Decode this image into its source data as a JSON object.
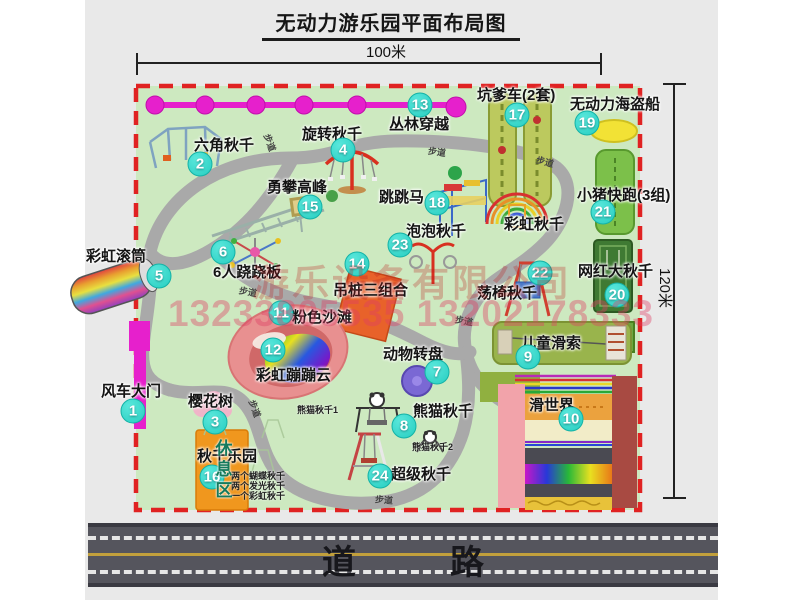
{
  "title": {
    "text": "无动力游乐园平面布局图"
  },
  "dimensions": {
    "width": "100米",
    "height": "120米"
  },
  "road": {
    "label": "道　路"
  },
  "rest_area": {
    "label": "休息区"
  },
  "watermark": {
    "company": "游乐设备有限公司",
    "phone": "13233805535 13202178333"
  },
  "colors": {
    "park_green": "#cde9c0",
    "border_red": "#e02222",
    "path_gray": "#a9a9a9",
    "badge_teal": "#27cdc0",
    "magenta": "#e620cc",
    "road_gray": "#55555d",
    "rest_orange": "#f0971e"
  },
  "map": {
    "attractions": [
      {
        "num": 1,
        "name": "风车大门",
        "label": [
          101,
          380
        ],
        "circle": [
          133,
          411
        ]
      },
      {
        "num": 2,
        "name": "六角秋千",
        "label": [
          194,
          134
        ],
        "circle": [
          200,
          164
        ]
      },
      {
        "num": 3,
        "name": "樱花树",
        "label": [
          188,
          390
        ],
        "circle": [
          215,
          422
        ]
      },
      {
        "num": 4,
        "name": "旋转秋千",
        "label": [
          302,
          123
        ],
        "circle": [
          343,
          150
        ]
      },
      {
        "num": 5,
        "name": "彩虹滚筒",
        "label": [
          86,
          245
        ],
        "circle": [
          159,
          276
        ]
      },
      {
        "num": 6,
        "name": "6人跷跷板",
        "label": [
          213,
          261
        ],
        "circle": [
          223,
          252
        ]
      },
      {
        "num": 7,
        "name": "动物转盘",
        "label": [
          383,
          343
        ],
        "circle": [
          437,
          372
        ]
      },
      {
        "num": 8,
        "name": "熊猫秋千",
        "label": [
          413,
          400
        ],
        "circle": [
          404,
          426
        ]
      },
      {
        "num": 9,
        "name": "儿童滑索",
        "label": [
          521,
          332
        ],
        "circle": [
          528,
          357
        ]
      },
      {
        "num": 10,
        "name": "滑世界",
        "label": [
          529,
          394
        ],
        "circle": [
          571,
          419
        ]
      },
      {
        "num": 11,
        "name": "粉色沙滩",
        "label": [
          292,
          306
        ],
        "circle": [
          281,
          313
        ]
      },
      {
        "num": 12,
        "name": "彩虹蹦蹦云",
        "label": [
          256,
          364
        ],
        "circle": [
          273,
          350
        ]
      },
      {
        "num": 13,
        "name": "丛林穿越",
        "label": [
          389,
          113
        ],
        "circle": [
          420,
          105
        ]
      },
      {
        "num": 14,
        "name": "吊桩三组合",
        "label": [
          333,
          279
        ],
        "circle": [
          357,
          264
        ]
      },
      {
        "num": 15,
        "name": "勇攀高峰",
        "label": [
          267,
          176
        ],
        "circle": [
          310,
          207
        ]
      },
      {
        "num": 16,
        "name": "秋千乐园",
        "label": [
          197,
          445
        ],
        "circle": [
          212,
          477
        ]
      },
      {
        "num": 17,
        "name": "坑爹车(2套)",
        "label": [
          477,
          84
        ],
        "circle": [
          517,
          115
        ]
      },
      {
        "num": 18,
        "name": "跳跳马",
        "label": [
          379,
          186
        ],
        "circle": [
          437,
          203
        ]
      },
      {
        "num": 19,
        "name": "无动力海盗船",
        "label": [
          570,
          93
        ],
        "circle": [
          587,
          123
        ]
      },
      {
        "num": 20,
        "name": "网红大秋千",
        "label": [
          578,
          260
        ],
        "circle": [
          617,
          295
        ]
      },
      {
        "num": 21,
        "name": "小猪快跑(3组)",
        "label": [
          577,
          184
        ],
        "circle": [
          603,
          212
        ]
      },
      {
        "num": 22,
        "name": "荡椅秋千",
        "label": [
          477,
          282
        ],
        "circle": [
          540,
          273
        ]
      },
      {
        "num": 23,
        "name": "泡泡秋千",
        "label": [
          406,
          220
        ],
        "circle": [
          400,
          245
        ]
      },
      {
        "num": 24,
        "name": "超级秋千",
        "label": [
          391,
          463
        ],
        "circle": [
          380,
          476
        ]
      }
    ],
    "unnumbered": [
      {
        "name": "彩虹秋千",
        "label": [
          504,
          213
        ]
      }
    ],
    "sub_labels": [
      {
        "text": "熊猫秋千1",
        "pos": [
          297,
          403
        ]
      },
      {
        "text": "熊猫秋千2",
        "pos": [
          412,
          440
        ]
      },
      {
        "text": "两个蝴蝶秋千",
        "pos": [
          231,
          469
        ]
      },
      {
        "text": "两个发光秋千",
        "pos": [
          231,
          479
        ]
      },
      {
        "text": "一个彩虹秋千",
        "pos": [
          231,
          489
        ]
      }
    ],
    "path_labels": [
      {
        "text": "步道",
        "pos": [
          261,
          136
        ],
        "rot": 70
      },
      {
        "text": "步道",
        "pos": [
          428,
          145
        ],
        "rot": 8
      },
      {
        "text": "步道",
        "pos": [
          536,
          155
        ],
        "rot": 15
      },
      {
        "text": "步道",
        "pos": [
          239,
          285
        ],
        "rot": 10
      },
      {
        "text": "步道",
        "pos": [
          455,
          314
        ],
        "rot": 10
      },
      {
        "text": "步道",
        "pos": [
          246,
          402
        ],
        "rot": 70
      },
      {
        "text": "步道",
        "pos": [
          375,
          493
        ],
        "rot": 5
      }
    ]
  }
}
